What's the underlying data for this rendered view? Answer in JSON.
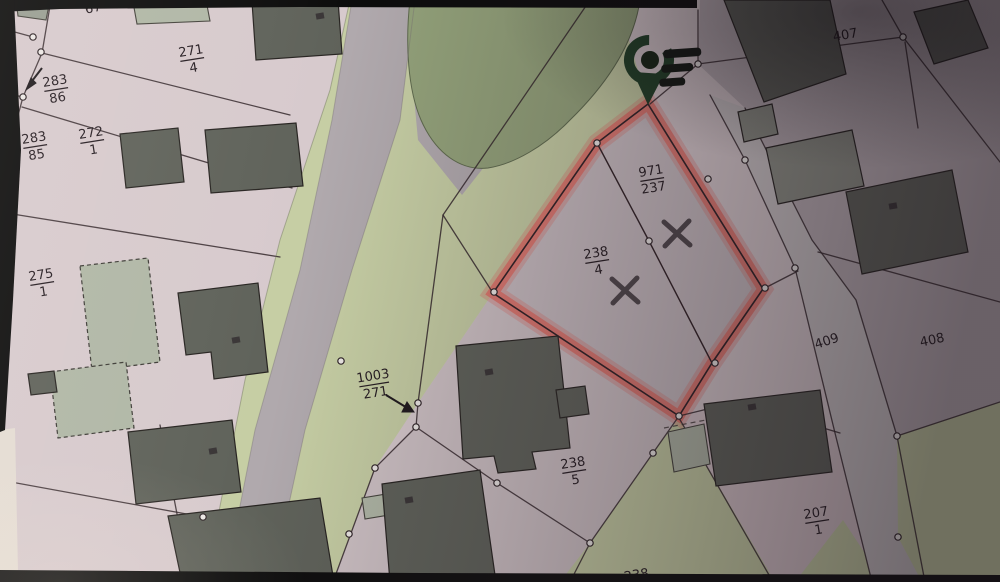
{
  "map": {
    "parcel_labels": [
      {
        "id": "67",
        "text": "67"
      },
      {
        "id": "271-4",
        "num": "271",
        "den": "4"
      },
      {
        "id": "283-86",
        "num": "283",
        "den": "86"
      },
      {
        "id": "283-85",
        "num": "283",
        "den": "85"
      },
      {
        "id": "272-1",
        "num": "272",
        "den": "1"
      },
      {
        "id": "275-1",
        "num": "275",
        "den": "1"
      },
      {
        "id": "1003-271",
        "num": "1003",
        "den": "271"
      },
      {
        "id": "971-237",
        "num": "971",
        "den": "237"
      },
      {
        "id": "238-4",
        "num": "238",
        "den": "4"
      },
      {
        "id": "238-5",
        "num": "238",
        "den": "5"
      },
      {
        "id": "238-bottom",
        "text": "238"
      },
      {
        "id": "207-1",
        "num": "207",
        "den": "1"
      },
      {
        "id": "407",
        "text": "407"
      },
      {
        "id": "408",
        "text": "408"
      },
      {
        "id": "409",
        "text": "409"
      }
    ],
    "highlighted_parcel": {
      "labels": [
        "971/237",
        "238/4"
      ],
      "highlight_color": "#ee6e64",
      "x_marks": [
        {
          "x": 677,
          "y": 233
        },
        {
          "x": 625,
          "y": 290
        }
      ]
    },
    "pin_icon": {
      "body_color": "#1b3f22",
      "bar_color": "#0e150e"
    },
    "colors": {
      "paper_pink": "#dccdd1",
      "block_pink": "#d3c5c9",
      "road_gray": "#b3abb0",
      "strip_gray": "#cfc8ca",
      "green_light": "#c9d2a2",
      "green_dark": "#94a577",
      "building_dark": "#5f6359",
      "building_sage": "#b2baa7",
      "boundary_line": "#332529"
    }
  }
}
